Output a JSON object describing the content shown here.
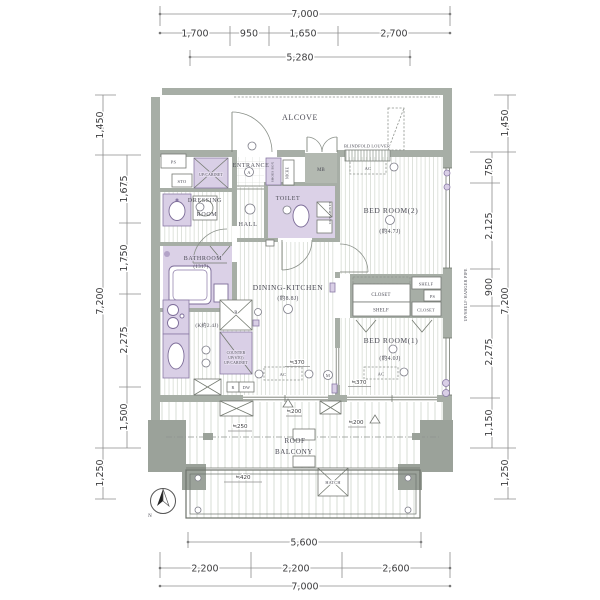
{
  "title": "Apartment floor plan",
  "colors": {
    "wall": "#a7aea6",
    "pillar": "#9ba29a",
    "fixture_purple": "#d9cfe6",
    "fixture_stroke": "#8a7aa6",
    "floor_hatch": "#d7dcd4",
    "dim_text": "#3d3d3f"
  },
  "dims": {
    "top_total": "7,000",
    "top_segs": [
      "1,700",
      "950",
      "1,650",
      "2,700"
    ],
    "top_sub": "5,280",
    "left_upper": "1,450",
    "left_total": "7,200",
    "left_segs": [
      "1,675",
      "1,750",
      "2,275",
      "1,500"
    ],
    "left_lower": "1,250",
    "right_upper": "1,450",
    "right_total": "7,200",
    "right_segs": [
      "750",
      "2,125",
      "900",
      "2,275",
      "1,150"
    ],
    "right_lower": "1,250",
    "bottom_sub": "5,600",
    "bottom_segs": [
      "2,200",
      "2,200",
      "2,600"
    ],
    "bottom_total": "7,000"
  },
  "rooms": {
    "alcove": "ALCOVE",
    "entrance": "ENTRANCE",
    "hall": "HALL",
    "dressing1": "DRESSING",
    "dressing2": "ROOM",
    "toilet": "TOILET",
    "bathroom": "BATHROOM",
    "bathroom_size": "(1317)",
    "dk": "DINING-KITCHEN",
    "dk_size": "(約8.8J)",
    "k_size": "(K約2.4J)",
    "br2": "BED ROOM(2)",
    "br2_size": "(約4.7J)",
    "br1": "BED ROOM(1)",
    "br1_size": "(約4.0J)",
    "roof": "ROOF",
    "balcony": "BALCONY"
  },
  "labels": {
    "mb": "MB",
    "ps": "PS",
    "sto": "STO",
    "up_cabinet": "UP/CABINET",
    "shoes_box": "SHOES BOX",
    "niche": "NICHE",
    "blindfold_louver": "BLINDFOLD LOUVER",
    "ac": "AC",
    "r": "R",
    "dw": "DW",
    "counter1": "COUNTER",
    "counter2": "UP(STO)",
    "counter3": "UP/CABINET",
    "shelf": "SHELF",
    "closet": "CLOSET",
    "hanger_pipe": "UP/SHELF·HANGER PIPE",
    "hatch": "HATCH",
    "north": "N",
    "circle_a": "A",
    "circle_m": "M"
  },
  "annots": {
    "d370": "≒370",
    "d200": "≒200",
    "d250": "≒250",
    "d420": "≒420"
  }
}
